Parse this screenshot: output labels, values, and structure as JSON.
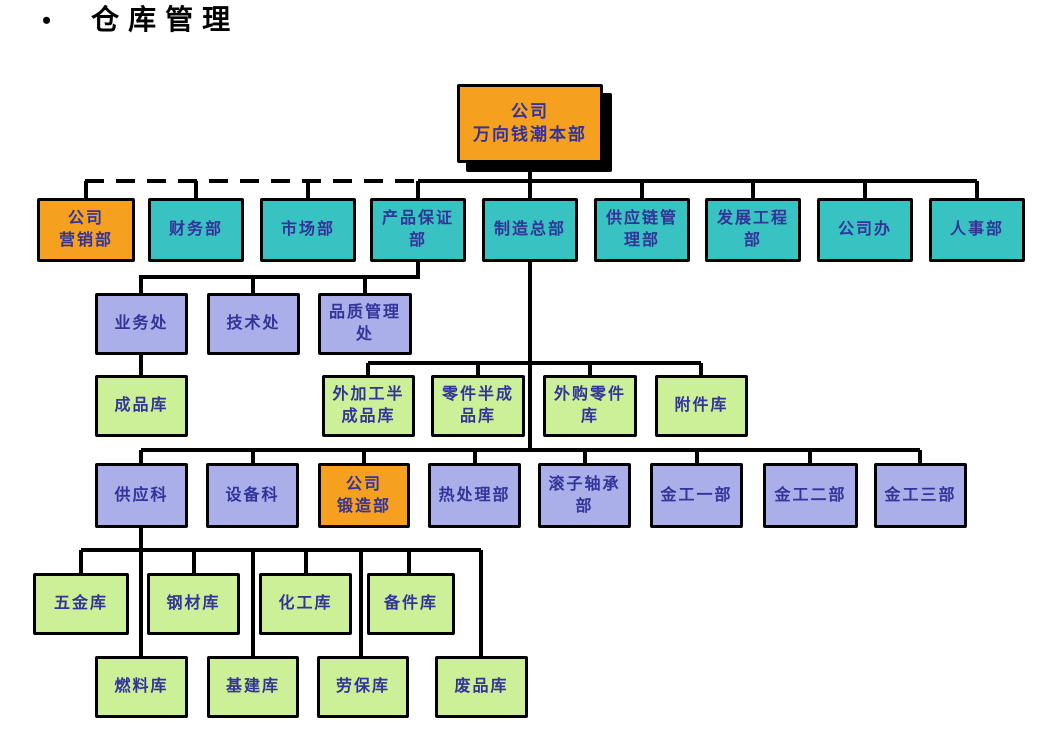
{
  "title": {
    "bullet": "•",
    "text": "仓库管理"
  },
  "colors": {
    "orange": "#F5A01E",
    "teal": "#38C2C2",
    "lavender": "#ABAFE9",
    "green": "#CBF098",
    "node_text": "#333399",
    "line": "#000000",
    "background": "#FFFFFF"
  },
  "chart": {
    "type": "org-chart",
    "nodes": [
      {
        "id": "root",
        "label": "公司\n万向钱潮本部",
        "x": 457,
        "y": 84,
        "w": 146,
        "h": 79,
        "color": "orange",
        "root": true
      },
      {
        "id": "gongsi-yingxiaobu",
        "label": "公司\n营销部",
        "x": 37,
        "y": 198,
        "w": 98,
        "h": 64,
        "color": "orange"
      },
      {
        "id": "caiwubu",
        "label": "财务部",
        "x": 148,
        "y": 198,
        "w": 96,
        "h": 64,
        "color": "teal"
      },
      {
        "id": "shichangbu",
        "label": "市场部",
        "x": 260,
        "y": 198,
        "w": 96,
        "h": 64,
        "color": "teal"
      },
      {
        "id": "chanpin-baozhengbu",
        "label": "产品保证\n部",
        "x": 370,
        "y": 198,
        "w": 96,
        "h": 64,
        "color": "teal"
      },
      {
        "id": "zhizao-zongbu",
        "label": "制造总部",
        "x": 482,
        "y": 198,
        "w": 96,
        "h": 64,
        "color": "teal"
      },
      {
        "id": "gongyinglian-guanlibu",
        "label": "供应链管\n理部",
        "x": 594,
        "y": 198,
        "w": 96,
        "h": 64,
        "color": "teal"
      },
      {
        "id": "fazhan-gongchengbu",
        "label": "发展工程\n部",
        "x": 705,
        "y": 198,
        "w": 96,
        "h": 64,
        "color": "teal"
      },
      {
        "id": "gongsiban",
        "label": "公司办",
        "x": 817,
        "y": 198,
        "w": 96,
        "h": 64,
        "color": "teal"
      },
      {
        "id": "renshibu",
        "label": "人事部",
        "x": 929,
        "y": 198,
        "w": 96,
        "h": 64,
        "color": "teal"
      },
      {
        "id": "yewuchu",
        "label": "业务处",
        "x": 95,
        "y": 293,
        "w": 93,
        "h": 62,
        "color": "lavender"
      },
      {
        "id": "jishuchu",
        "label": "技术处",
        "x": 207,
        "y": 293,
        "w": 93,
        "h": 62,
        "color": "lavender"
      },
      {
        "id": "pinzhi-guanlichu",
        "label": "品质管理\n处",
        "x": 318,
        "y": 293,
        "w": 94,
        "h": 62,
        "color": "lavender"
      },
      {
        "id": "chengpinku",
        "label": "成品库",
        "x": 95,
        "y": 375,
        "w": 93,
        "h": 62,
        "color": "green"
      },
      {
        "id": "waijiagong-banchengpinku",
        "label": "外加工半\n成品库",
        "x": 322,
        "y": 375,
        "w": 93,
        "h": 62,
        "color": "green"
      },
      {
        "id": "lingjian-banchengpinku",
        "label": "零件半成\n品库",
        "x": 431,
        "y": 375,
        "w": 94,
        "h": 62,
        "color": "green"
      },
      {
        "id": "waigou-lingjianku",
        "label": "外购零件\n库",
        "x": 543,
        "y": 375,
        "w": 94,
        "h": 62,
        "color": "green"
      },
      {
        "id": "fujianku",
        "label": "附件库",
        "x": 655,
        "y": 375,
        "w": 93,
        "h": 62,
        "color": "green"
      },
      {
        "id": "gongyingke",
        "label": "供应科",
        "x": 95,
        "y": 463,
        "w": 93,
        "h": 65,
        "color": "lavender"
      },
      {
        "id": "shebeike",
        "label": "设备科",
        "x": 206,
        "y": 463,
        "w": 93,
        "h": 65,
        "color": "lavender"
      },
      {
        "id": "gongsi-duanzaobu",
        "label": "公司\n锻造部",
        "x": 318,
        "y": 463,
        "w": 92,
        "h": 65,
        "color": "orange"
      },
      {
        "id": "rechulibu",
        "label": "热处理部",
        "x": 428,
        "y": 463,
        "w": 93,
        "h": 65,
        "color": "lavender"
      },
      {
        "id": "gunzi-zhouchengbu",
        "label": "滚子轴承\n部",
        "x": 538,
        "y": 463,
        "w": 93,
        "h": 65,
        "color": "lavender"
      },
      {
        "id": "jingong-yibu",
        "label": "金工一部",
        "x": 650,
        "y": 463,
        "w": 93,
        "h": 65,
        "color": "lavender"
      },
      {
        "id": "jingong-erbu",
        "label": "金工二部",
        "x": 763,
        "y": 463,
        "w": 95,
        "h": 65,
        "color": "lavender"
      },
      {
        "id": "jingong-sanbu",
        "label": "金工三部",
        "x": 874,
        "y": 463,
        "w": 93,
        "h": 65,
        "color": "lavender"
      },
      {
        "id": "wujinku",
        "label": "五金库",
        "x": 33,
        "y": 573,
        "w": 96,
        "h": 62,
        "color": "green"
      },
      {
        "id": "gangcaiku",
        "label": "钢材库",
        "x": 147,
        "y": 573,
        "w": 93,
        "h": 62,
        "color": "green"
      },
      {
        "id": "huagongku",
        "label": "化工库",
        "x": 259,
        "y": 573,
        "w": 93,
        "h": 62,
        "color": "green"
      },
      {
        "id": "beijianku",
        "label": "备件库",
        "x": 367,
        "y": 573,
        "w": 88,
        "h": 62,
        "color": "green"
      },
      {
        "id": "ranliaoku",
        "label": "燃料库",
        "x": 95,
        "y": 656,
        "w": 93,
        "h": 62,
        "color": "green"
      },
      {
        "id": "jijianku",
        "label": "基建库",
        "x": 207,
        "y": 656,
        "w": 92,
        "h": 62,
        "color": "green"
      },
      {
        "id": "laobaoku",
        "label": "劳保库",
        "x": 317,
        "y": 656,
        "w": 92,
        "h": 62,
        "color": "green"
      },
      {
        "id": "feipinku",
        "label": "废品库",
        "x": 435,
        "y": 656,
        "w": 93,
        "h": 62,
        "color": "green"
      }
    ],
    "edges": [
      {
        "points": [
          [
            530,
            163
          ],
          [
            530,
            181
          ]
        ],
        "dashed": false
      },
      {
        "points": [
          [
            85,
            181
          ],
          [
            418,
            181
          ]
        ],
        "dashed": true
      },
      {
        "points": [
          [
            418,
            181
          ],
          [
            977,
            181
          ]
        ],
        "dashed": false
      },
      {
        "points": [
          [
            86,
            181
          ],
          [
            86,
            198
          ]
        ],
        "dashed": false
      },
      {
        "points": [
          [
            196,
            181
          ],
          [
            196,
            198
          ]
        ],
        "dashed": false
      },
      {
        "points": [
          [
            308,
            181
          ],
          [
            308,
            198
          ]
        ],
        "dashed": false
      },
      {
        "points": [
          [
            418,
            181
          ],
          [
            418,
            198
          ]
        ],
        "dashed": false
      },
      {
        "points": [
          [
            530,
            181
          ],
          [
            530,
            198
          ]
        ],
        "dashed": false
      },
      {
        "points": [
          [
            642,
            181
          ],
          [
            642,
            198
          ]
        ],
        "dashed": false
      },
      {
        "points": [
          [
            753,
            181
          ],
          [
            753,
            198
          ]
        ],
        "dashed": false
      },
      {
        "points": [
          [
            865,
            181
          ],
          [
            865,
            198
          ]
        ],
        "dashed": false
      },
      {
        "points": [
          [
            977,
            181
          ],
          [
            977,
            198
          ]
        ],
        "dashed": false
      },
      {
        "points": [
          [
            418,
            262
          ],
          [
            418,
            277
          ],
          [
            141,
            277
          ],
          [
            141,
            293
          ]
        ],
        "dashed": false
      },
      {
        "points": [
          [
            253,
            277
          ],
          [
            253,
            293
          ]
        ],
        "dashed": false
      },
      {
        "points": [
          [
            365,
            277
          ],
          [
            365,
            293
          ]
        ],
        "dashed": false
      },
      {
        "points": [
          [
            141,
            355
          ],
          [
            141,
            375
          ]
        ],
        "dashed": false
      },
      {
        "points": [
          [
            530,
            262
          ],
          [
            530,
            450
          ]
        ],
        "dashed": false
      },
      {
        "points": [
          [
            368,
            363
          ],
          [
            701,
            363
          ]
        ],
        "dashed": false
      },
      {
        "points": [
          [
            368,
            363
          ],
          [
            368,
            375
          ]
        ],
        "dashed": false
      },
      {
        "points": [
          [
            478,
            363
          ],
          [
            478,
            375
          ]
        ],
        "dashed": false
      },
      {
        "points": [
          [
            590,
            363
          ],
          [
            590,
            375
          ]
        ],
        "dashed": false
      },
      {
        "points": [
          [
            701,
            363
          ],
          [
            701,
            375
          ]
        ],
        "dashed": false
      },
      {
        "points": [
          [
            141,
            450
          ],
          [
            920,
            450
          ]
        ],
        "dashed": false
      },
      {
        "points": [
          [
            141,
            450
          ],
          [
            141,
            463
          ]
        ],
        "dashed": false
      },
      {
        "points": [
          [
            253,
            450
          ],
          [
            253,
            463
          ]
        ],
        "dashed": false
      },
      {
        "points": [
          [
            364,
            450
          ],
          [
            364,
            463
          ]
        ],
        "dashed": false
      },
      {
        "points": [
          [
            475,
            450
          ],
          [
            475,
            463
          ]
        ],
        "dashed": false
      },
      {
        "points": [
          [
            585,
            450
          ],
          [
            585,
            463
          ]
        ],
        "dashed": false
      },
      {
        "points": [
          [
            697,
            450
          ],
          [
            697,
            463
          ]
        ],
        "dashed": false
      },
      {
        "points": [
          [
            810,
            450
          ],
          [
            810,
            463
          ]
        ],
        "dashed": false
      },
      {
        "points": [
          [
            920,
            450
          ],
          [
            920,
            463
          ]
        ],
        "dashed": false
      },
      {
        "points": [
          [
            141,
            528
          ],
          [
            141,
            550
          ]
        ],
        "dashed": false
      },
      {
        "points": [
          [
            81,
            550
          ],
          [
            481,
            550
          ]
        ],
        "dashed": false
      },
      {
        "points": [
          [
            81,
            550
          ],
          [
            81,
            573
          ]
        ],
        "dashed": false
      },
      {
        "points": [
          [
            194,
            550
          ],
          [
            194,
            573
          ]
        ],
        "dashed": false
      },
      {
        "points": [
          [
            306,
            550
          ],
          [
            306,
            573
          ]
        ],
        "dashed": false
      },
      {
        "points": [
          [
            409,
            550
          ],
          [
            409,
            573
          ]
        ],
        "dashed": false
      },
      {
        "points": [
          [
            141,
            550
          ],
          [
            141,
            656
          ]
        ],
        "dashed": false
      },
      {
        "points": [
          [
            253,
            550
          ],
          [
            253,
            656
          ]
        ],
        "dashed": false
      },
      {
        "points": [
          [
            361,
            550
          ],
          [
            361,
            656
          ]
        ],
        "dashed": false
      },
      {
        "points": [
          [
            481,
            550
          ],
          [
            481,
            656
          ]
        ],
        "dashed": false
      }
    ]
  }
}
